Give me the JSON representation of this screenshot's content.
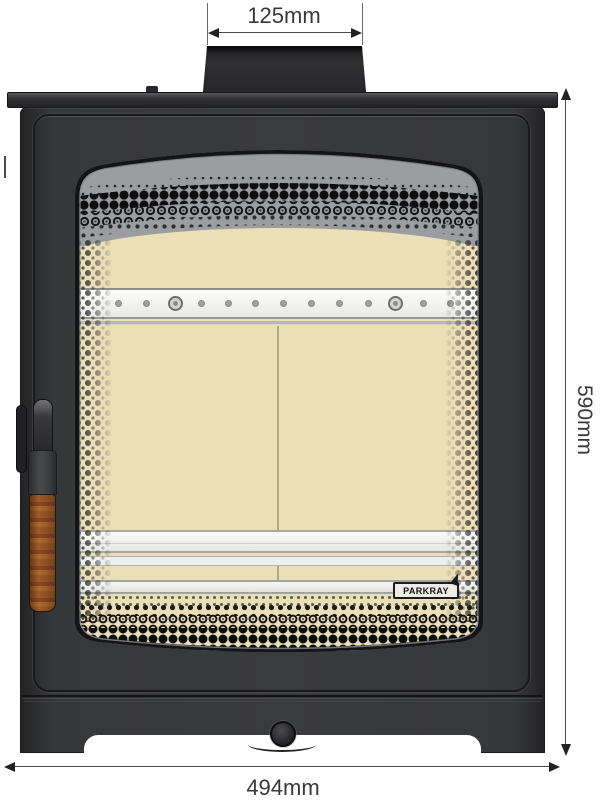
{
  "drawing": {
    "type": "technical front elevation of a wood-burning stove",
    "dimensions": {
      "flue_width_label": "125mm",
      "overall_height_label": "590mm",
      "overall_width_label": "494mm"
    },
    "brand": {
      "logo_text": "PARKRAY"
    },
    "colors": {
      "stove_body": "#37383b",
      "firebrick": "#eadfb6",
      "baffle_shade": "#9b9da0",
      "retainer_bars": "#f0f0ee",
      "wood_handle": "#a25b28",
      "dimension_text": "#383838"
    }
  }
}
